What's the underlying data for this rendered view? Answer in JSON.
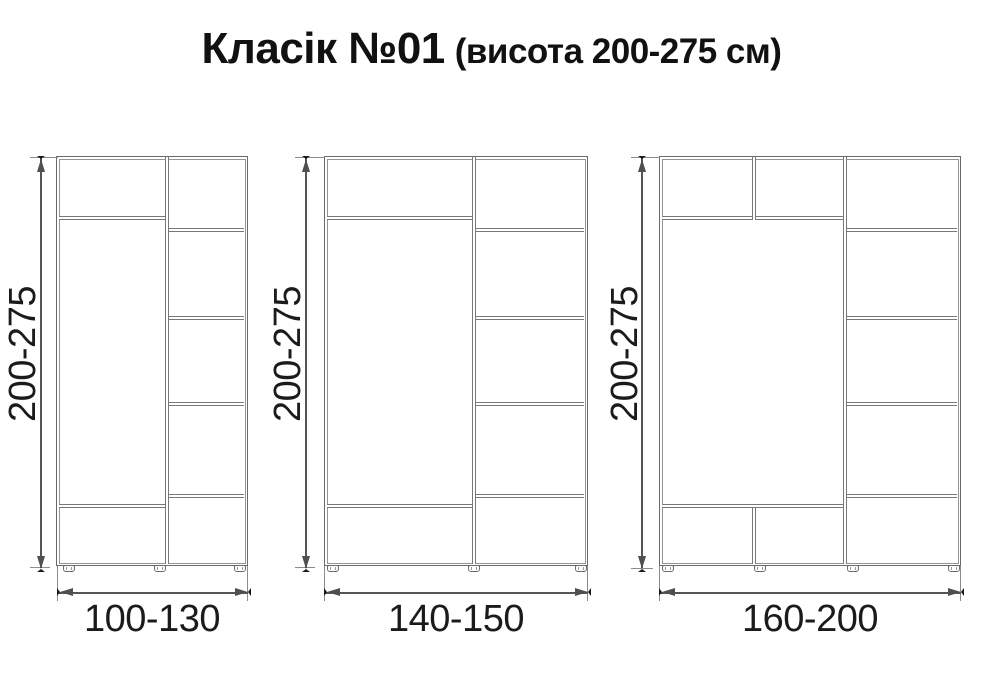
{
  "title": {
    "main": "Класік №01",
    "suffix": "(висота 200-275 см)"
  },
  "colors": {
    "background": "#ffffff",
    "drawing_line": "#6a6a6a",
    "dimension_line": "#4f4f4f",
    "text": "#1a1a1a"
  },
  "wardrobes": [
    {
      "name": "variant-1",
      "height_label": "200-275",
      "width_label": "100-130",
      "columns": 2,
      "left_column_sections": 3,
      "right_column_sections": 5,
      "feet": 3
    },
    {
      "name": "variant-2",
      "height_label": "200-275",
      "width_label": "140-150",
      "columns": 2,
      "left_column_sections": 3,
      "right_column_sections": 5,
      "feet": 3
    },
    {
      "name": "variant-3",
      "height_label": "200-275",
      "width_label": "160-200",
      "columns": 2,
      "left_column_sections": 7,
      "right_column_sections": 5,
      "feet": 4
    }
  ]
}
